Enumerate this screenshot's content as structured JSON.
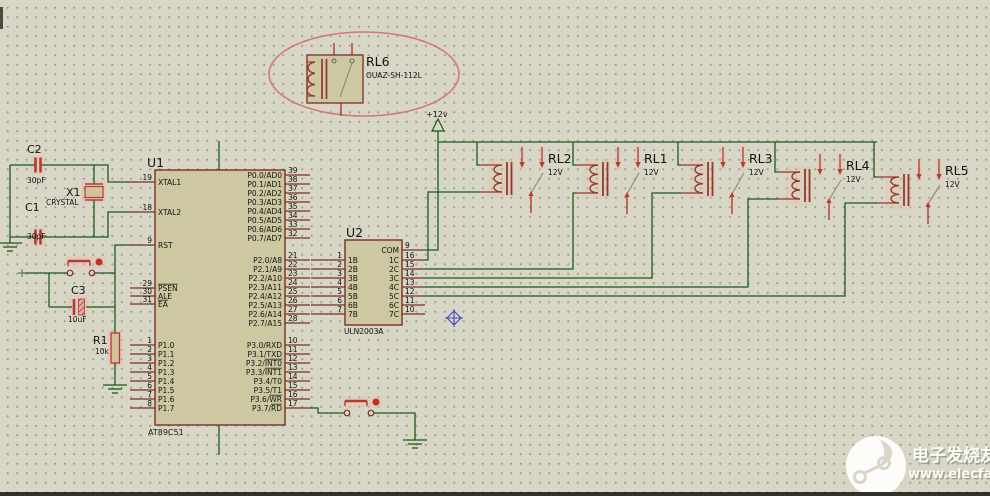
{
  "colors": {
    "background": "#d8d7c6",
    "grid_dot": "#9c9c8c",
    "wire_green": "#1a5a1a",
    "pin_dark_red": "#7c2d26",
    "component_red": "#b43a32",
    "relay_coil": "#8f3a30",
    "chip_fill": "#cdc8a2",
    "chip_border": "#7c2d26",
    "annotation_ellipse": "#cf7a72",
    "cursor_blue": "#4444bb",
    "watermark_white": "#fcfcf6"
  },
  "power": {
    "label": "+12v"
  },
  "rl6": {
    "ref": "RL6",
    "part": "OUAZ-SH-112L"
  },
  "u1": {
    "ref": "U1",
    "part": "AT89C51",
    "left_pins": [
      {
        "num": "19",
        "name": "XTAL1"
      },
      {
        "num": "18",
        "name": "XTAL2"
      },
      {
        "num": "9",
        "name": "RST"
      },
      {
        "num": "29",
        "name": "",
        "bar": "PSEN"
      },
      {
        "num": "30",
        "name": "ALE"
      },
      {
        "num": "31",
        "name": "",
        "bar": "EA"
      },
      {
        "num": "1",
        "name": "P1.0"
      },
      {
        "num": "2",
        "name": "P1.1"
      },
      {
        "num": "3",
        "name": "P1.2"
      },
      {
        "num": "4",
        "name": "P1.3"
      },
      {
        "num": "5",
        "name": "P1.4"
      },
      {
        "num": "6",
        "name": "P1.5"
      },
      {
        "num": "7",
        "name": "P1.6"
      },
      {
        "num": "8",
        "name": "P1.7"
      }
    ],
    "right_pins": [
      {
        "num": "39",
        "name": "P0.0/AD0"
      },
      {
        "num": "38",
        "name": "P0.1/AD1"
      },
      {
        "num": "37",
        "name": "P0.2/AD2"
      },
      {
        "num": "36",
        "name": "P0.3/AD3"
      },
      {
        "num": "35",
        "name": "P0.4/AD4"
      },
      {
        "num": "34",
        "name": "P0.5/AD5"
      },
      {
        "num": "33",
        "name": "P0.6/AD6"
      },
      {
        "num": "32",
        "name": "P0.7/AD7"
      },
      {
        "num": "21",
        "name": "P2.0/A8"
      },
      {
        "num": "22",
        "name": "P2.1/A9"
      },
      {
        "num": "23",
        "name": "P2.2/A10"
      },
      {
        "num": "24",
        "name": "P2.3/A11"
      },
      {
        "num": "25",
        "name": "P2.4/A12"
      },
      {
        "num": "26",
        "name": "P2.5/A13"
      },
      {
        "num": "27",
        "name": "P2.6/A14"
      },
      {
        "num": "28",
        "name": "P2.7/A15"
      },
      {
        "num": "10",
        "name": "P3.0/RXD"
      },
      {
        "num": "11",
        "name": "P3.1/TXD"
      },
      {
        "num": "12",
        "name": "P3.2/",
        "bar": "INT0"
      },
      {
        "num": "13",
        "name": "P3.3/",
        "bar": "INT1"
      },
      {
        "num": "14",
        "name": "P3.4/T0"
      },
      {
        "num": "15",
        "name": "P3.5/T1"
      },
      {
        "num": "16",
        "name": "P3.6/",
        "bar": "WR"
      },
      {
        "num": "17",
        "name": "P3.7/",
        "bar": "RD"
      }
    ]
  },
  "u2": {
    "ref": "U2",
    "part": "ULN2003A",
    "left_pins": [
      {
        "num": "1",
        "name": "1B"
      },
      {
        "num": "2",
        "name": "2B"
      },
      {
        "num": "3",
        "name": "3B"
      },
      {
        "num": "4",
        "name": "4B"
      },
      {
        "num": "5",
        "name": "5B"
      },
      {
        "num": "6",
        "name": "6B"
      },
      {
        "num": "7",
        "name": "7B"
      }
    ],
    "right_pins": [
      {
        "num": "9",
        "name": "COM"
      },
      {
        "num": "16",
        "name": "1C"
      },
      {
        "num": "15",
        "name": "2C"
      },
      {
        "num": "14",
        "name": "3C"
      },
      {
        "num": "13",
        "name": "4C"
      },
      {
        "num": "12",
        "name": "5C"
      },
      {
        "num": "11",
        "name": "6C"
      },
      {
        "num": "10",
        "name": "7C"
      }
    ]
  },
  "relays": [
    {
      "ref": "RL2",
      "value": "12V"
    },
    {
      "ref": "RL1",
      "value": "12V"
    },
    {
      "ref": "RL3",
      "value": "12V"
    },
    {
      "ref": "RL4",
      "value": "12V"
    },
    {
      "ref": "RL5",
      "value": "12V"
    }
  ],
  "discrete": {
    "c2": {
      "ref": "C2",
      "value": "30pF"
    },
    "c1": {
      "ref": "C1",
      "value": "30pF"
    },
    "x1": {
      "ref": "X1",
      "part": "CRYSTAL"
    },
    "c3": {
      "ref": "C3",
      "value": "10uF"
    },
    "r1": {
      "ref": "R1",
      "value": "10k"
    }
  },
  "watermark": {
    "name": "电子发烧友",
    "url": "www.elecfans.com"
  }
}
